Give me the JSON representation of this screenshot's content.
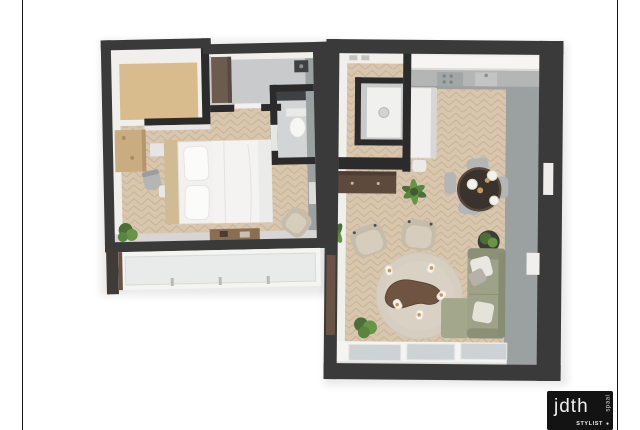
{
  "scene": {
    "type": "3d-floor-plan-render",
    "units": [
      {
        "name": "bedroom-suite",
        "rooms": [
          "entry-nook",
          "hallway",
          "bathroom",
          "bedroom",
          "window-bay"
        ],
        "furniture": [
          "wardrobe-cabinet",
          "wall-sink",
          "toilet",
          "wood-shelf-unit",
          "desk-chair",
          "stool",
          "nightstand",
          "double-bed",
          "pillows",
          "foot-bench",
          "plant",
          "lounge-chair",
          "radiator"
        ]
      },
      {
        "name": "living-unit",
        "rooms": [
          "entry-hall",
          "closet",
          "kitchen",
          "living-dining-room"
        ],
        "furniture": [
          "washing-machine",
          "kitchen-counter",
          "tall-cabinet",
          "sideboard",
          "dining-table",
          "dining-chairs",
          "pendant-lamps",
          "potted-plants",
          "corner-sofa",
          "sofa-pillows",
          "armchairs",
          "round-rug",
          "coffee-table",
          "candles",
          "window-wall",
          "wall-door"
        ]
      }
    ]
  },
  "logo": {
    "brand": "jdth",
    "vertical_text": "spaai",
    "tagline": "STYLIST",
    "dot": "●"
  },
  "colors": {
    "frameLine": "#161616",
    "logoBg": "#131313",
    "wall": "#3a3a3a",
    "wallDark": "#2b2b2b",
    "faceLight": "#f0efec",
    "faceGrey": "#9ba0a1",
    "wood": "#d8c6ae",
    "woodline": "#c7b296",
    "beigeMat": "#d9bc8e",
    "greyFloor": "#c9cacb",
    "bathFloor": "#d3d4d5",
    "glass": "#cdd2d4",
    "windowWhite": "#f4f4f2",
    "bedWhite": "#f2f1ef",
    "pillowWhite": "#fbfbfa",
    "headboard": "#d1bb95",
    "shelf": "#c9ad80",
    "bench": "#8a6e52",
    "wardrobe": "#6d5b50",
    "sideboard": "#5d4a3c",
    "tableDark": "#3a322c",
    "tableEdge": "#55473a",
    "sofa": "#9da288",
    "sofaDark": "#8b9077",
    "armBeige": "#c6bcab",
    "armSeat": "#d6cdbc",
    "rug": "#d6cfc1",
    "coffee": "#6f5442",
    "plantDark": "#4c6e38",
    "plantLight": "#679447",
    "chairGrey": "#b3b6b5",
    "pendant": "#f4f2ec",
    "gold": "#c59a5d",
    "doorBrown": "#6a5244",
    "fixtureDark": "#3f4042",
    "washer": "#f0f0ee"
  }
}
